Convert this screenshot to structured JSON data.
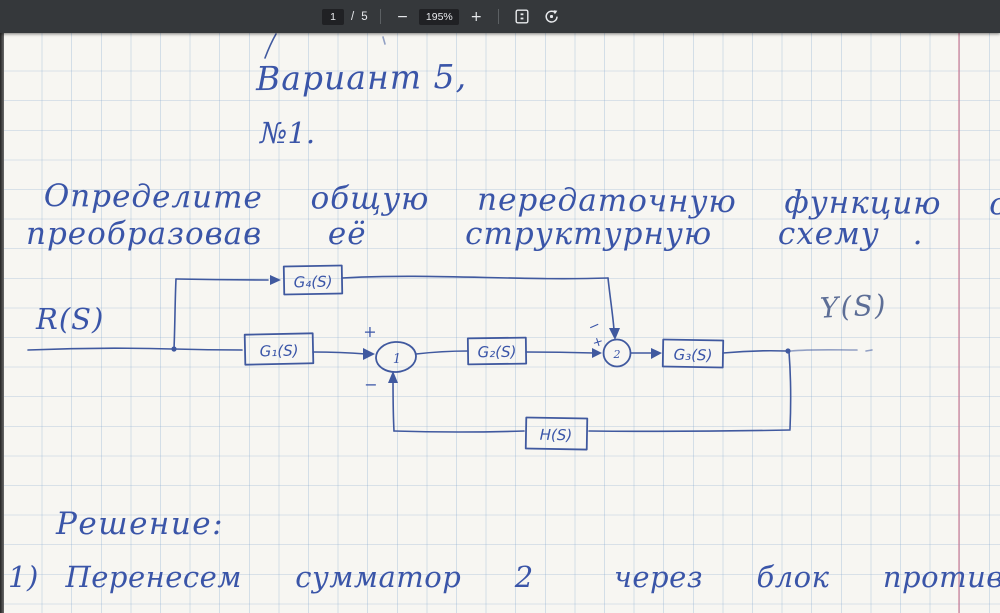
{
  "toolbar": {
    "page_current": "1",
    "page_divider": "/",
    "page_total": "5",
    "zoom_out_label": "−",
    "zoom_level": "195%",
    "zoom_in_label": "+"
  },
  "page": {
    "variant_title": "Вариант 5,",
    "task_number": "№1.",
    "task_line1": "Определите  общую  передаточную  функцию  системы,",
    "task_line2": "преобразовав  её   структурную  схему .",
    "solution_heading": "Решение:",
    "step1": "1) Перенесем  сумматор  2   через  блок  против  хода  сигнала:"
  },
  "diagram": {
    "input_label": "R(S)",
    "output_label": "Y(S)",
    "blocks": {
      "g1": "G₁(S)",
      "g2": "G₂(S)",
      "g3": "G₃(S)",
      "g4": "G₄(S)",
      "h": "H(S)"
    },
    "junctions": {
      "j1": "1",
      "j2": "2"
    },
    "signs": {
      "j1_top": "+",
      "j1_bottom": "−",
      "j2_top": "−",
      "j2_left": "+"
    }
  },
  "colors": {
    "ink": "#3a55a8",
    "toolbar_bg": "#35383b",
    "paper": "#f7f6f2",
    "margin_line": "#c9718c"
  }
}
